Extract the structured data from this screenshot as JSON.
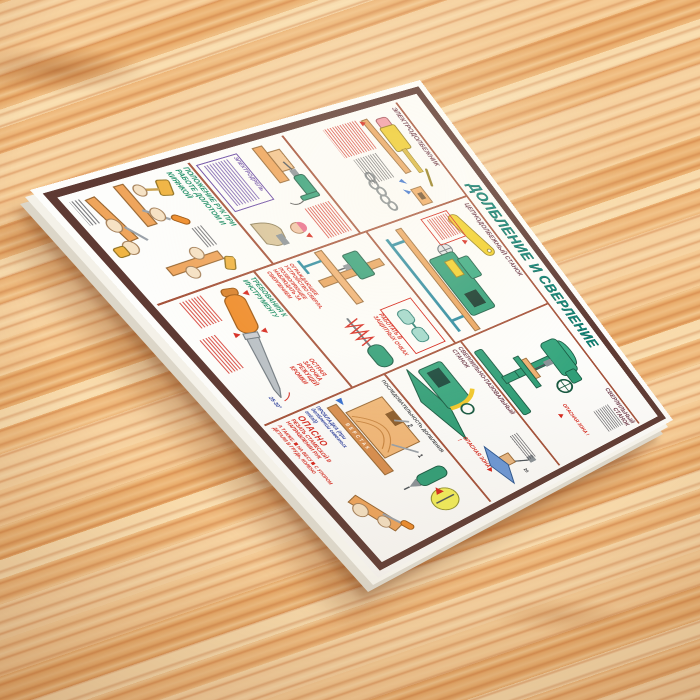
{
  "colors": {
    "wood_base": "#f0c08a",
    "wood_streak": "#c97a42",
    "paper": "#fdfdfb",
    "outer_frame": "#5e3a33",
    "panel_line": "#a5523a",
    "title_teal": "#0e8173",
    "section_label": "#6e3a4a",
    "green_heading": "#12895f",
    "warning_red": "#d6281e",
    "violet_note": "#6f50a8",
    "machine_green": "#2f9f78",
    "machine_yellow": "#f2d028",
    "wood_part_orange": "#efa55c",
    "steel_gray": "#b9c0c6"
  },
  "poster": {
    "title": "ДОЛБЛЕНИЕ И СВЕРЛЕНИЕ",
    "warnings": {
      "danger_zone": "ОПАСНАЯ ЗОНА !"
    },
    "sections": {
      "electric_mortiser": {
        "label": "ЭЛЕКТРОДОЛБЕЖНИК"
      },
      "electric_drill": {
        "label": "ЭЛЕКТРОДРЕЛЬ"
      },
      "hands_position": {
        "label": "ПОЛОЖЕНИЕ РУК ПРИ РАБОТЕ ДОЛОТОМ И КИЯНКОЙ"
      },
      "chain_mortiser": {
        "label": "ЦЕПНОДОЛБЕЖНЫЙ СТАНОК"
      },
      "drill_press": {
        "label": "СВЕРЛИЛЬНЫЙ СТАНОК",
        "goggles_note": "РАБОТАТЬ В ЗАЩИТНЫХ ОЧКАХ"
      },
      "drill_guard": {
        "note": "ОГРАЖДАЮЩЕЕ УСТРОЙСТВО СВЕРЛА, ПОЗВОЛЯЮЩЕЕ НАБЛЮДАТЬ ЗА СВЕРЛЕНИЕМ"
      },
      "tool_requirements": {
        "label": "ТРЕБОВАНИЯ К ИНСТРУМЕНТУ",
        "sharp_note": "ОСТРАЯ ЗАТОЧКА РЕЖУЩЕЙ КРОМКИ",
        "angle_note": "25-30°"
      },
      "slot_mortiser": {
        "label": "СВЕРЛИЛЬНО-ПАЗОВАЛЬНЫЙ СТАНОК",
        "dimension": "20"
      },
      "chisel_sequence": {
        "label": "ПОСЛЕДОВАТЕЛЬНОСТЬ ДОЛБЛЕНИЯ",
        "bench_label": "ВЕРСТАК",
        "spacer_note": "ПРОКЛАДКА (при долблении сквозных гнёзд)",
        "step_1": "1",
        "step_2": "2"
      },
      "danger": {
        "label": "ОПАСНО",
        "text": "РЕЗАТЬ СТАМЕСКОЙ В НАПРАВЛЕНИИ РУК",
        "also": "А ТАКЖЕ:",
        "bullet_1": "НА ВЕСУ",
        "bullet_2": "С УПОРОМ ДЕТАЛИ В ГРУДЬ, КОЛЕНО"
      }
    }
  }
}
